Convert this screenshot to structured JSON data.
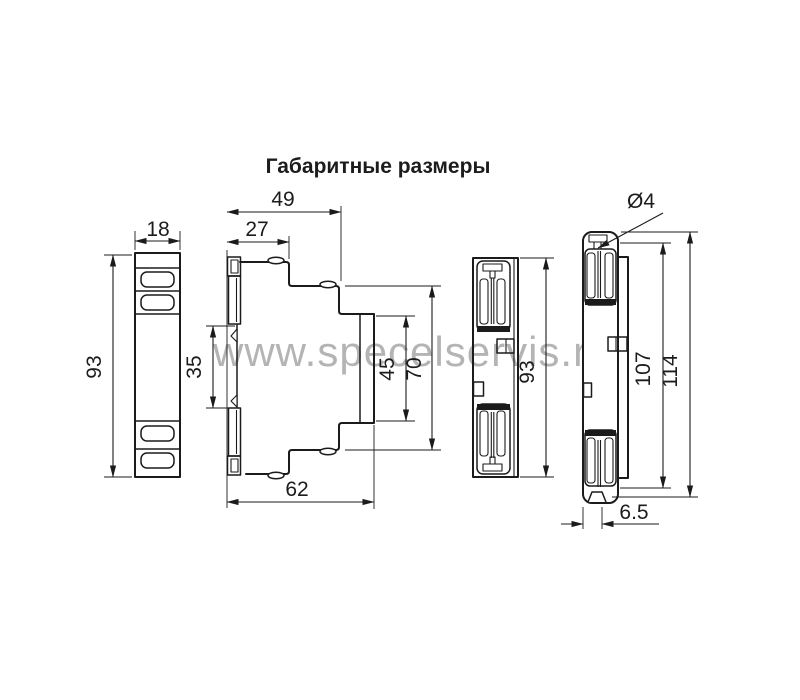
{
  "title": "Габаритные размеры",
  "watermark": "www.specelservis.ru",
  "views": {
    "front": {
      "width": "18",
      "height": "93"
    },
    "profile": {
      "top_width": "49",
      "front_step_width": "27",
      "front_face_height": "35",
      "rear_recess_height": "45",
      "rear_height": "70",
      "bottom_width": "62"
    },
    "rear": {
      "height": "93"
    },
    "edge": {
      "hole": "Ø4",
      "inner_height": "107",
      "total_height": "114",
      "bottom_offset": "6.5"
    }
  },
  "colors": {
    "line": "#1b1b1b",
    "watermark": "#b4b4b4",
    "background": "#ffffff"
  }
}
